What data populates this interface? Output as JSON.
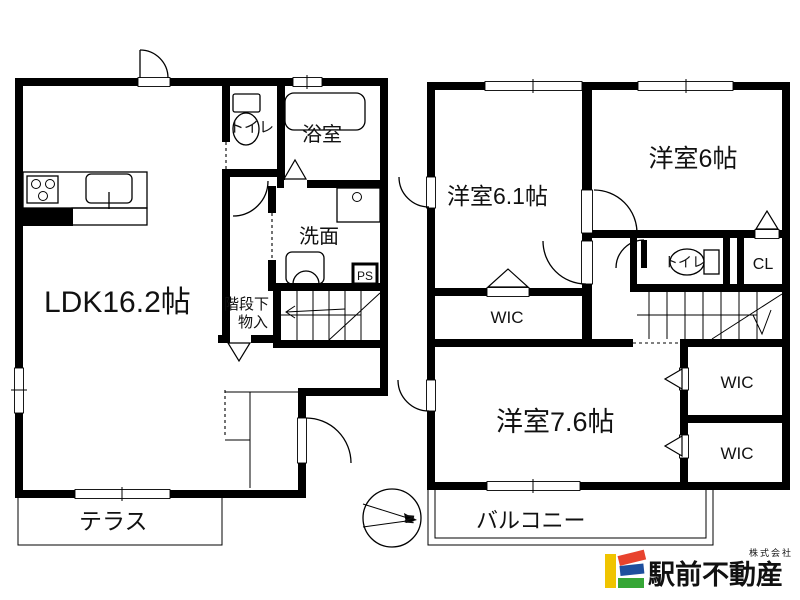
{
  "floor1": {
    "ldk": "LDK16.2帖",
    "toilet": "トイレ",
    "bath": "浴室",
    "wash": "洗面",
    "ps": "PS",
    "stair_storage_line1": "階段下",
    "stair_storage_line2": "物入",
    "terrace": "テラス"
  },
  "floor2": {
    "room_a": "洋室6.1帖",
    "room_b": "洋室6帖",
    "toilet": "トイレ",
    "cl": "CL",
    "wic_left": "WIC",
    "room_c": "洋室7.6帖",
    "wic_right_top": "WIC",
    "wic_right_bottom": "WIC",
    "balcony": "バルコニー"
  },
  "compass": {
    "north": "N"
  },
  "logo": {
    "company_prefix": "株式会社",
    "company_name": "駅前不動産",
    "colors": {
      "red": "#e8432e",
      "yellow": "#f0c400",
      "blue": "#1e4f9e",
      "green": "#36a636",
      "text": "#8d8a8a"
    }
  }
}
